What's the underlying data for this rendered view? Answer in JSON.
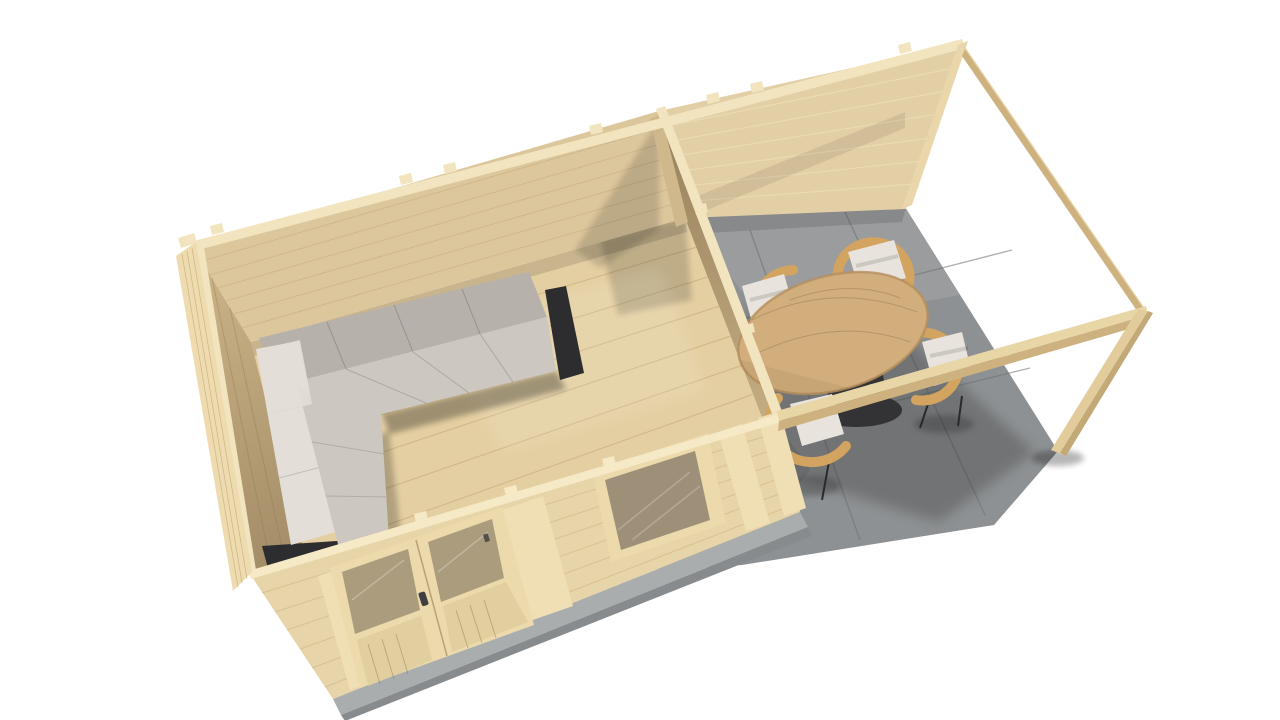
{
  "scene": {
    "type": "3d-render",
    "subject": "Elevated isometric 3D render of a wooden garden cabin with an enclosed lounge room and an open pergola terrace",
    "background": "#ffffff",
    "room": {
      "walls": "light log planks",
      "floor": "wood planks",
      "furniture": "L-shaped corner sofa with grey cushions on black base"
    },
    "terrace": {
      "floor": "grey concrete pavers",
      "structure": "open pergola frame with corner post and top beams",
      "table": "round wooden dining table with dark pedestal",
      "chairs": 4,
      "chair_style": "rattan wrap-around frame with light cushions"
    },
    "facade": {
      "door": "double door with glazed upper panels",
      "window": "single fixed window",
      "base": "concrete foundation strip"
    }
  },
  "colors": {
    "background": "#ffffff",
    "cap": "#f2e4bf",
    "cap_bright": "#f6e9c6",
    "wood_exterior_front": "#e7d4a8",
    "wood_exterior_left": "#eedcb0",
    "wall_interior_back": "#dcc69c",
    "wall_interior_terrace": "#e3cfa6",
    "wall_interior_left": "#c9b186",
    "partition_dark": "#9b8560",
    "partition_light": "#cfb88c",
    "trim_strip": "#f0dfb4",
    "floor_wood": "#e4cfa2",
    "floor_plank": "#c9ae7e",
    "wall_plank_dark": "#c9b284",
    "wall_plank_light": "#f3e4bd",
    "door_frame": "#ecd9ac",
    "door_glass": "#ab9c7d",
    "door_panel": "#e2cf9f",
    "window_glass": "#9e9078",
    "foundation": "#a9adae",
    "foundation_dark": "#878b8d",
    "pavement": "#8e9193",
    "pavement_light": "#9da0a2",
    "pavement_dark": "#7b7e81",
    "pavement_joint": "#6e7174",
    "beam_top": "#e9d6a7",
    "beam_side": "#cdb280",
    "post": "#e2cc9c",
    "post_edge": "#c3a878",
    "wall_end": "#e9d7ab",
    "sofa_back": "#b6b1ab",
    "sofa_seat": "#ccc7c0",
    "sofa_white": "#e3dfd8",
    "sofa_base": "#2d2d2f",
    "table_top": "#d2ae7c",
    "table_edge": "#b58f5e",
    "table_base": "#333335",
    "rattan": "#d3a360",
    "rattan_dark": "#b9884a",
    "cushion": "#e8e4dd",
    "leg": "#2a2a2c",
    "handle": "#3f3f41"
  }
}
